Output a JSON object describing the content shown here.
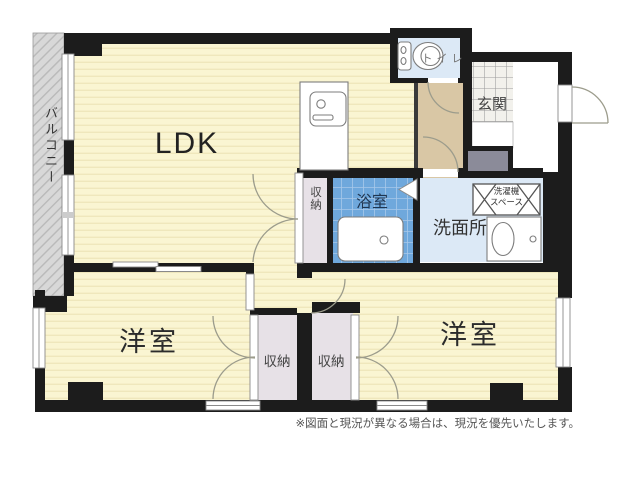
{
  "floorplan": {
    "rooms": {
      "ldk": "LDK",
      "bedroom_left": "洋室",
      "bedroom_right": "洋室",
      "bathroom": "浴室",
      "washroom": "洗面所",
      "entrance": "玄関",
      "toilet": "トイレ",
      "balcony": "バルコニー",
      "storage_hall": "収納",
      "storage_left": "収納",
      "storage_right": "収納"
    },
    "laundry_space": {
      "line1": "洗濯機",
      "line2": "スペース"
    },
    "footer_note": "※図面と現況が異なる場合は、現況を優先いたします。",
    "colors": {
      "wall": "#1C1C1C",
      "room_floor": "#FAF5D2",
      "room_floor_stripe": "#EFE7BC",
      "balcony_gray": "#D8D8D8",
      "bath_tile_blue": "#6FA8DC",
      "light_blue": "#DCE9F6",
      "hall_tan": "#D9C7A5",
      "closet_lavender": "#E7E1E7",
      "entrance_tile": "#F2F1EC",
      "shoe_cabinet_gray": "#8B8B99",
      "door_arc": "#9C9C8C"
    }
  }
}
